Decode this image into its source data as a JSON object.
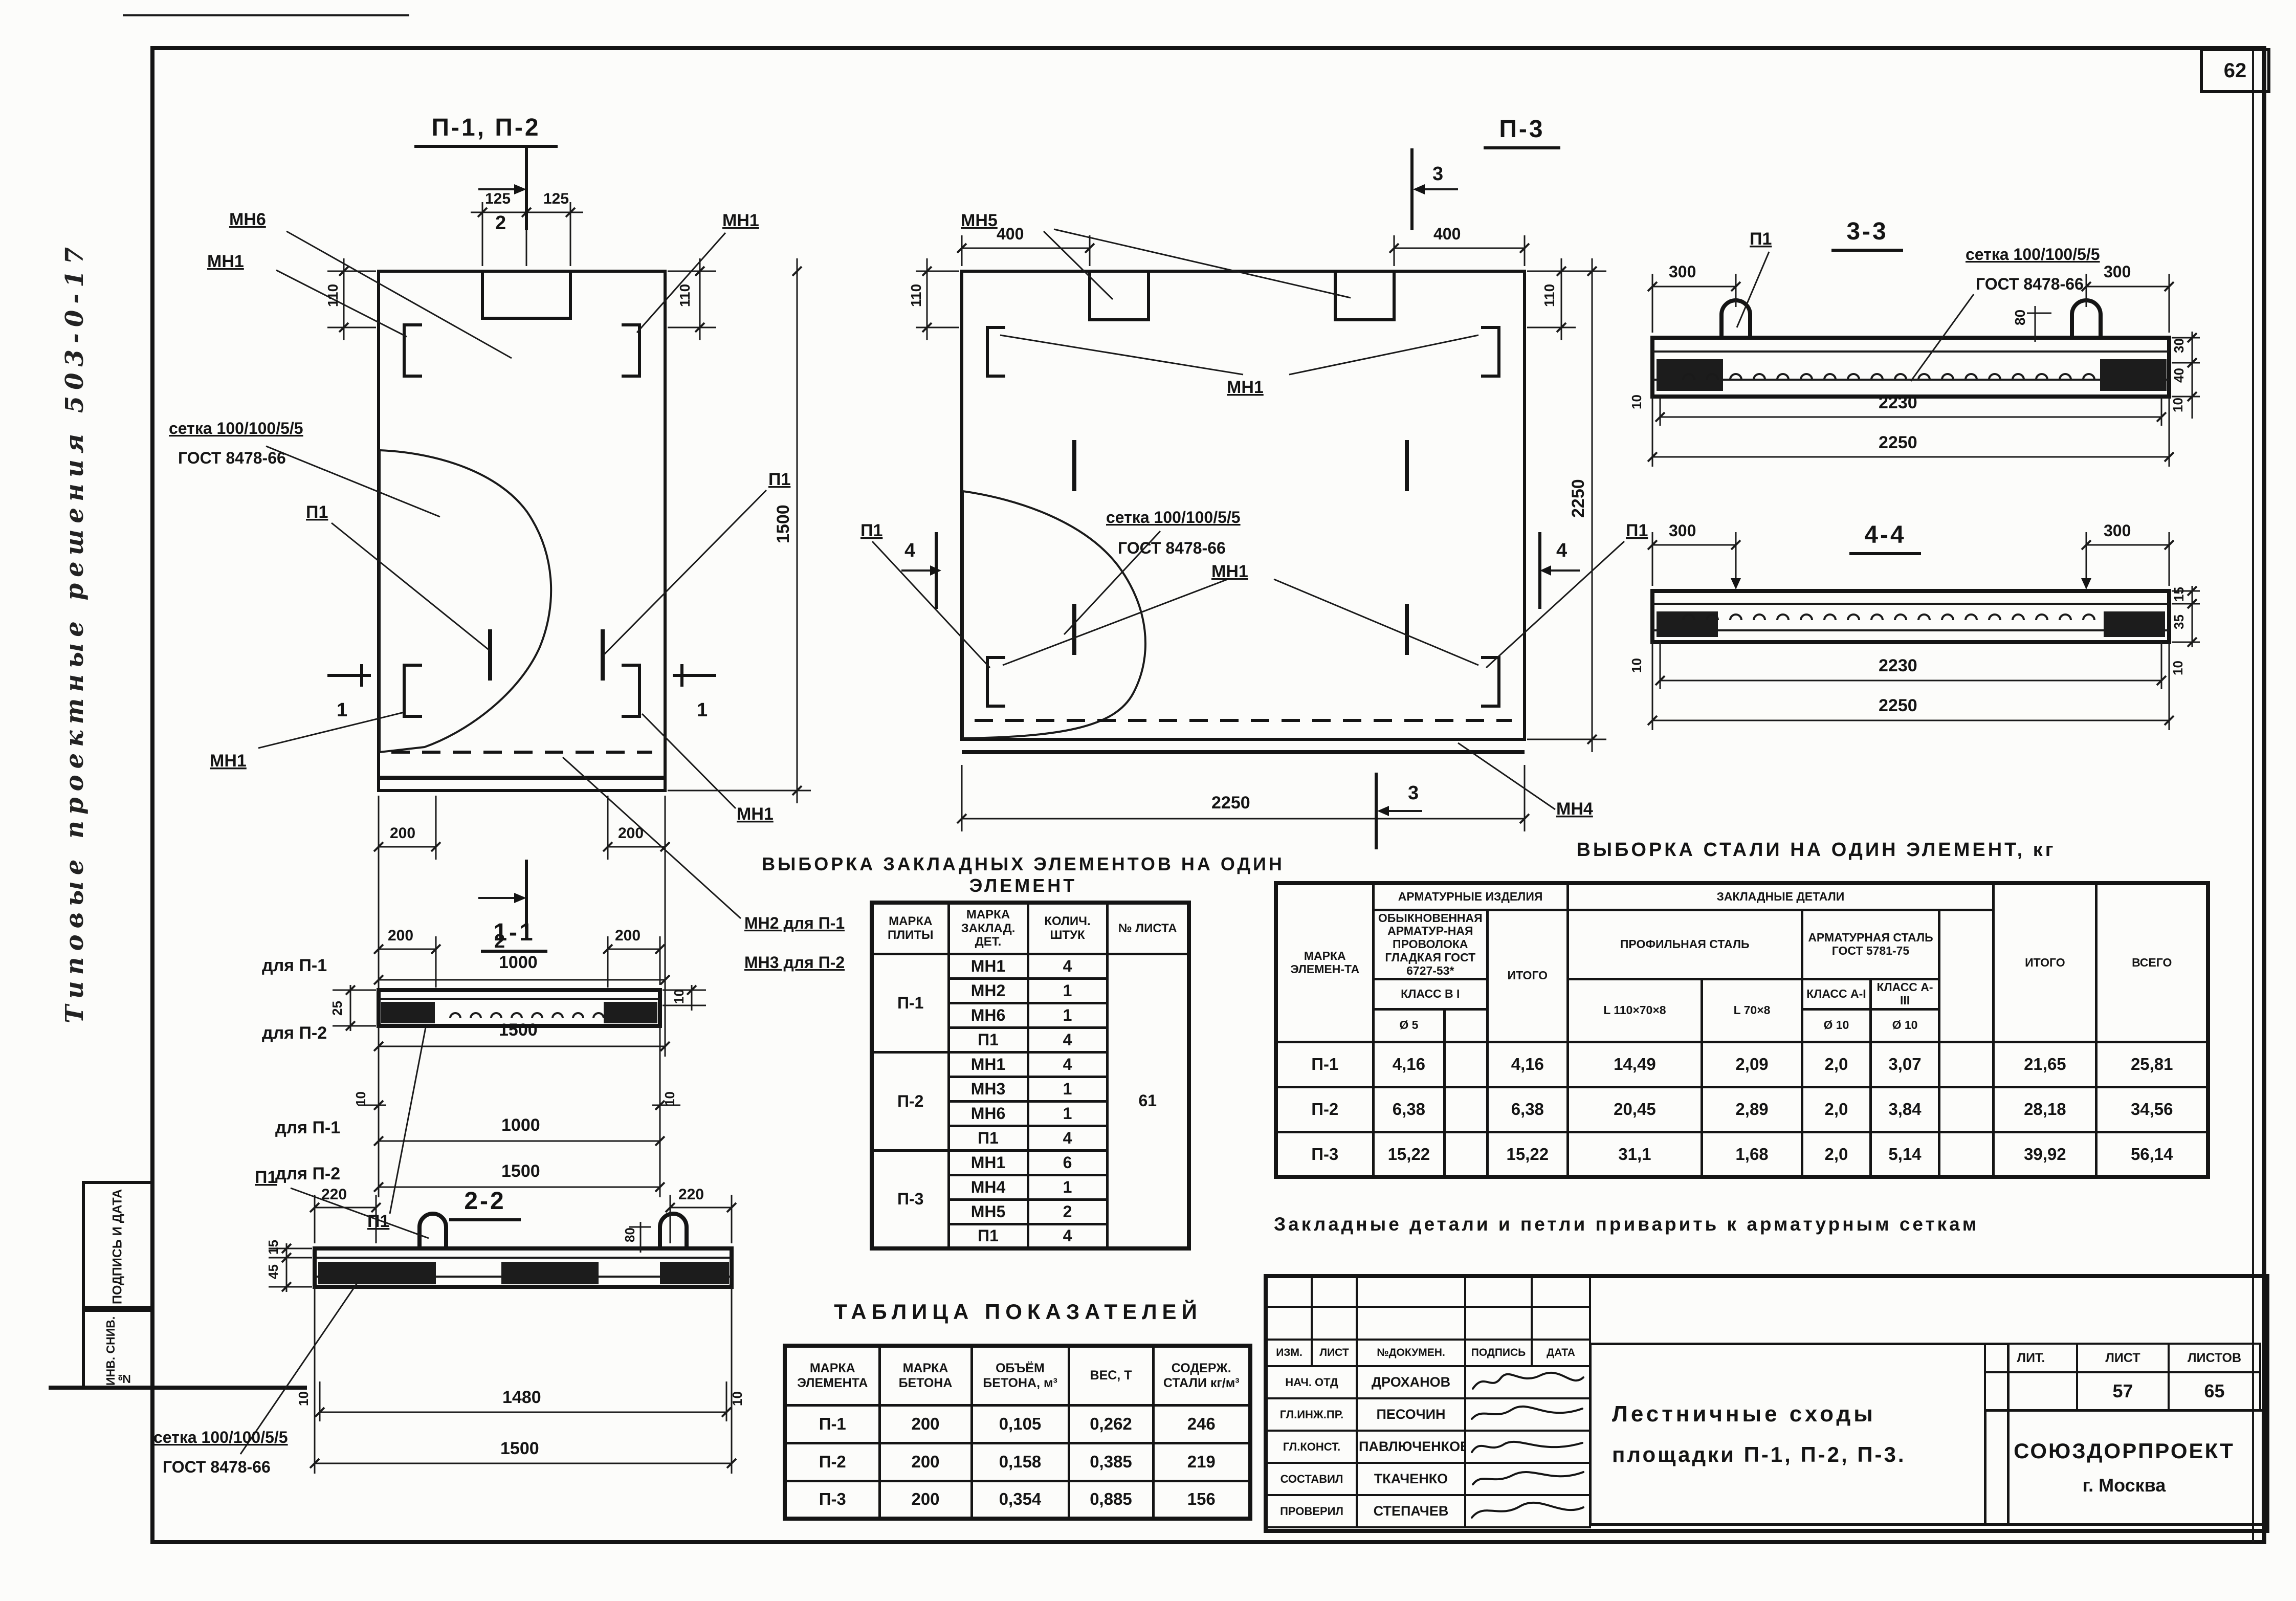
{
  "page": {
    "number": "62"
  },
  "margin": {
    "handwritten": "Типовые  проектные  решения  503-0-17",
    "box_sign": "ПОДПИСЬ И ДАТА",
    "box_inv": "ИНВ. СНИВ. №"
  },
  "drawings": {
    "p12": {
      "title": "П-1, П-2",
      "mn6": "МН6",
      "mn1_tl": "МН1",
      "mn1_tr": "МН1",
      "mn1_bl": "МН1",
      "mn1_br": "МН1",
      "p1_l": "П1",
      "p1_r": "П1",
      "mn2": "МН2 для П-1",
      "mn3": "МН3 для П-2",
      "mesh1": "сетка 100/100/5/5",
      "mesh2": "ГОСТ 8478-66",
      "sec2t": "2",
      "sec2b": "2",
      "sec1l": "1",
      "sec1r": "1",
      "d125a": "125",
      "d125b": "125",
      "d110l": "110",
      "d110r": "110",
      "d1500r": "1500",
      "d200l": "200",
      "d200r": "200",
      "rowp1_label": "для П-1",
      "rowp1_val": "1000",
      "rowp2_label": "для П-2",
      "rowp2_val": "1500"
    },
    "p3": {
      "title": "П-3",
      "mn5": "МН5",
      "mn1_t": "МН1",
      "mn1_b": "МН1",
      "mn4": "МН4",
      "p1_l": "П1",
      "p1_r": "П1",
      "mesh1": "сетка 100/100/5/5",
      "mesh2": "ГОСТ 8478-66",
      "sec3t": "3",
      "sec3b": "3",
      "sec4l": "4",
      "sec4r": "4",
      "d400l": "400",
      "d400r": "400",
      "d110l": "110",
      "d110r": "110",
      "d2250b": "2250",
      "d2250r": "2250"
    },
    "s33": {
      "title": "3-3",
      "p1": "П1",
      "mesh1": "сетка 100/100/5/5",
      "mesh2": "ГОСТ 8478-66",
      "d300l": "300",
      "d300r": "300",
      "d80": "80",
      "d30": "30",
      "d40": "40",
      "d10l": "10",
      "d10r": "10",
      "d2230": "2230",
      "d2250": "2250"
    },
    "s44": {
      "title": "4-4",
      "d300l": "300",
      "d300r": "300",
      "d15": "15",
      "d35": "35",
      "d10l": "10",
      "d10r": "10",
      "d2230": "2230",
      "d2250": "2250"
    },
    "s11": {
      "title": "1-1",
      "p1": "П1",
      "d200l": "200",
      "d200r": "200",
      "d25": "25",
      "d10r": "10",
      "d10bl": "10",
      "d10br": "10",
      "rowp1_label": "для П-1",
      "rowp1_val": "1000",
      "rowp2_label": "для П-2",
      "rowp2_val": "1500"
    },
    "s22": {
      "title": "2-2",
      "p1": "П1",
      "mesh1": "сетка 100/100/5/5",
      "mesh2": "ГОСТ 8478-66",
      "d220l": "220",
      "d220r": "220",
      "d80": "80",
      "d15": "15",
      "d45": "45",
      "d10l": "10",
      "d10r": "10",
      "d1480": "1480",
      "d1500": "1500"
    }
  },
  "tables": {
    "zakl": {
      "title": "ВЫБОРКА ЗАКЛАДНЫХ ЭЛЕМЕНТОВ НА ОДИН ЭЛЕМЕНТ",
      "h_mark": "МАРКА ПЛИТЫ",
      "h_det": "МАРКА ЗАКЛАД. ДЕТ.",
      "h_qty": "КОЛИЧ. ШТУК",
      "h_sheet": "№ ЛИСТА",
      "sheet_no": "61",
      "groups": [
        {
          "mark": "П-1",
          "rows": [
            [
              "МН1",
              "4"
            ],
            [
              "МН2",
              "1"
            ],
            [
              "МН6",
              "1"
            ],
            [
              "П1",
              "4"
            ]
          ]
        },
        {
          "mark": "П-2",
          "rows": [
            [
              "МН1",
              "4"
            ],
            [
              "МН3",
              "1"
            ],
            [
              "МН6",
              "1"
            ],
            [
              "П1",
              "4"
            ]
          ]
        },
        {
          "mark": "П-3",
          "rows": [
            [
              "МН1",
              "6"
            ],
            [
              "МН4",
              "1"
            ],
            [
              "МН5",
              "2"
            ],
            [
              "П1",
              "4"
            ]
          ]
        }
      ]
    },
    "steel": {
      "title": "ВЫБОРКА СТАЛИ НА ОДИН ЭЛЕМЕНТ, кг",
      "h_mark": "МАРКА ЭЛЕМЕН-ТА",
      "h_arm": "АРМАТУРНЫЕ ИЗДЕЛИЯ",
      "h_wire": "ОБЫКНОВЕННАЯ АРМАТУР-НАЯ ПРОВОЛОКА ГЛАДКАЯ ГОСТ 6727-53*",
      "h_classB": "КЛАСС В I",
      "h_d5": "Ø 5",
      "h_itogo1": "ИТОГО",
      "h_zakl": "ЗАКЛАДНЫЕ  ДЕТАЛИ",
      "h_prof": "ПРОФИЛЬНАЯ СТАЛЬ",
      "h_L1": "L 110×70×8",
      "h_L2": "L 70×8",
      "h_armstal": "АРМАТУРНАЯ СТАЛЬ ГОСТ 5781-75",
      "h_classA1": "КЛАСС А-I",
      "h_classA3": "КЛАСС А-III",
      "h_d10a": "Ø 10",
      "h_d10b": "Ø 10",
      "h_itogo2": "ИТОГО",
      "h_vsego": "ВСЕГО",
      "rows": [
        [
          "П-1",
          "4,16",
          "",
          "4,16",
          "14,49",
          "2,09",
          "2,0",
          "3,07",
          "",
          "21,65",
          "25,81"
        ],
        [
          "П-2",
          "6,38",
          "",
          "6,38",
          "20,45",
          "2,89",
          "2,0",
          "3,84",
          "",
          "28,18",
          "34,56"
        ],
        [
          "П-3",
          "15,22",
          "",
          "15,22",
          "31,1",
          "1,68",
          "2,0",
          "5,14",
          "",
          "39,92",
          "56,14"
        ]
      ]
    },
    "pokaz": {
      "title": "ТАБЛИЦА   ПОКАЗАТЕЛЕЙ",
      "headers": [
        "МАРКА ЭЛЕМЕНТА",
        "МАРКА БЕТОНА",
        "ОБЪЁМ БЕТОНА, м³",
        "ВЕС, Т",
        "СОДЕРЖ. СТАЛИ кг/м³"
      ],
      "rows": [
        [
          "П-1",
          "200",
          "0,105",
          "0,262",
          "246"
        ],
        [
          "П-2",
          "200",
          "0,158",
          "0,385",
          "219"
        ],
        [
          "П-3",
          "200",
          "0,354",
          "0,885",
          "156"
        ]
      ]
    }
  },
  "note": "Закладные  детали  и  петли  приварить  к  арматурным  сеткам",
  "titleblock": {
    "header": [
      "ИЗМ.",
      "ЛИСТ",
      "№ДОКУМЕН.",
      "ПОДПИСЬ",
      "ДАТА"
    ],
    "sig_rows": [
      {
        "role": "НАЧ. ОТД",
        "name": "ДРОХАНОВ"
      },
      {
        "role": "ГЛ.ИНЖ.ПР.",
        "name": "ПЕСОЧИН"
      },
      {
        "role": "ГЛ.КОНСТ.",
        "name": "ПАВЛЮЧЕНКОВ"
      },
      {
        "role": "СОСТАВИЛ",
        "name": "ТКАЧЕНКО"
      },
      {
        "role": "ПРОВЕРИЛ",
        "name": "СТЕПАЧЕВ"
      }
    ],
    "doc_title1": "Лестничные  сходы",
    "doc_title2": "площадки  П-1, П-2, П-3.",
    "lit_label": "ЛИТ.",
    "list_label": "ЛИСТ",
    "listov_label": "ЛИСТОВ",
    "lit": "",
    "list": "57",
    "listov": "65",
    "org": "СОЮЗДОРПРОЕКТ",
    "city": "г. Москва"
  }
}
